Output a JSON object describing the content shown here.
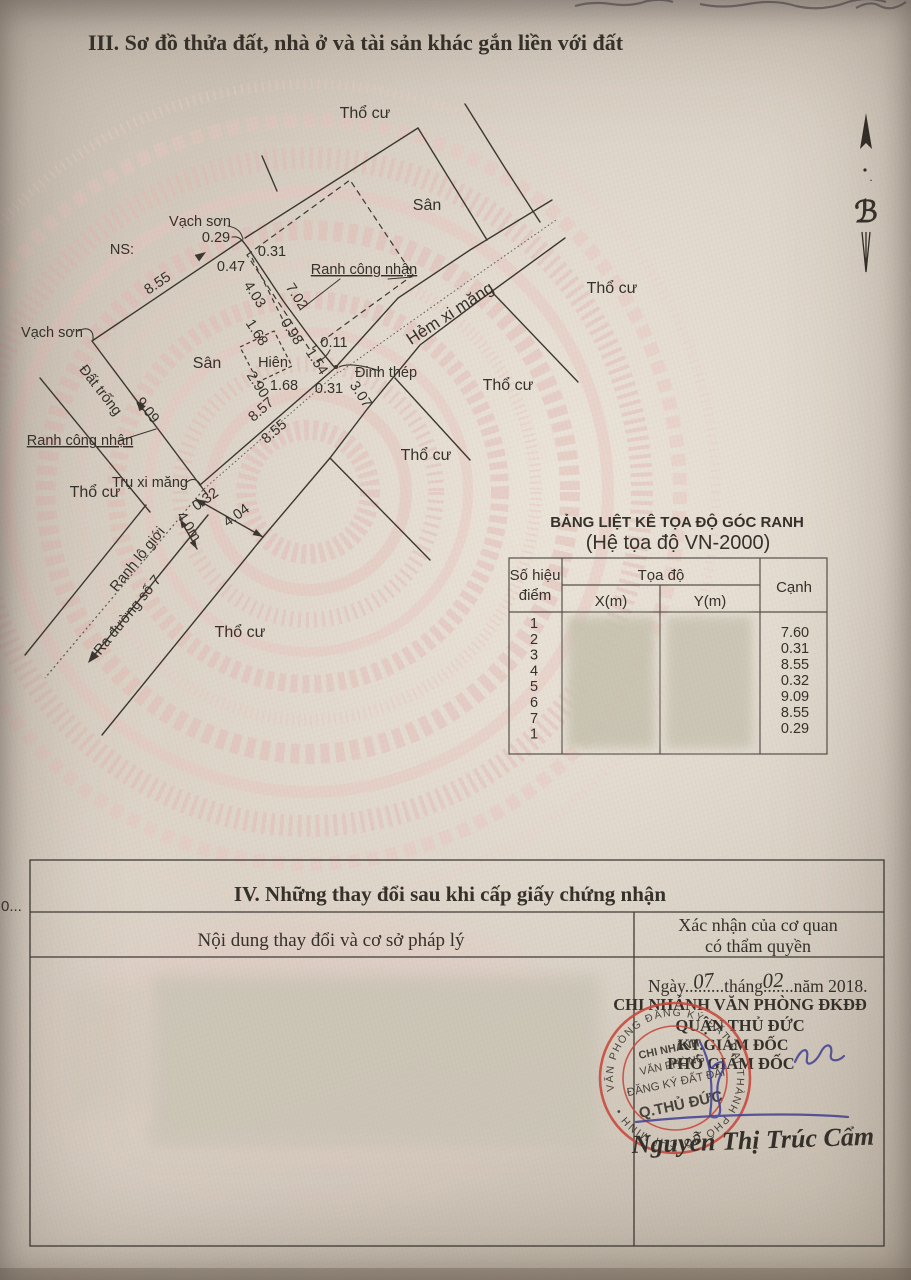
{
  "header": {
    "section_title": "III. Sơ đồ thửa đất, nhà ở và tài sản khác gắn liền với đất"
  },
  "compass": {
    "glyph": "ℬ",
    "dot": "."
  },
  "diagram": {
    "labels": [
      {
        "t": "Thổ cư",
        "x": 365,
        "y": 118,
        "s": 16
      },
      {
        "t": "Sân",
        "x": 427,
        "y": 210,
        "s": 16
      },
      {
        "t": "Vạch sơn",
        "x": 200,
        "y": 226
      },
      {
        "t": "0.29",
        "x": 216,
        "y": 242
      },
      {
        "t": "NS:",
        "x": 122,
        "y": 254
      },
      {
        "t": "0.31",
        "x": 272,
        "y": 256
      },
      {
        "t": "0.47",
        "x": 231,
        "y": 271
      },
      {
        "t": "8.55",
        "x": 160,
        "y": 287,
        "r": -34
      },
      {
        "t": "4.03",
        "x": 251,
        "y": 297,
        "r": 57
      },
      {
        "t": "7.02",
        "x": 293,
        "y": 299,
        "r": 57
      },
      {
        "t": "Ranh công nhận",
        "x": 364,
        "y": 274,
        "u": true
      },
      {
        "t": "1.68",
        "x": 253,
        "y": 335,
        "r": 57
      },
      {
        "t": "0.98",
        "x": 288,
        "y": 334,
        "r": 57
      },
      {
        "t": "0.11",
        "x": 334,
        "y": 347
      },
      {
        "t": "Sân",
        "x": 207,
        "y": 368,
        "s": 16
      },
      {
        "t": "Hiên",
        "x": 273,
        "y": 367
      },
      {
        "t": "1.54",
        "x": 313,
        "y": 364,
        "r": 57
      },
      {
        "t": "Đinh thép",
        "x": 386,
        "y": 377
      },
      {
        "t": "2.90",
        "x": 254,
        "y": 387,
        "r": 57
      },
      {
        "t": "1.68",
        "x": 284,
        "y": 390
      },
      {
        "t": "0.31",
        "x": 329,
        "y": 393
      },
      {
        "t": "3.07",
        "x": 357,
        "y": 397,
        "r": 57
      },
      {
        "t": "8.57",
        "x": 264,
        "y": 413,
        "r": -41
      },
      {
        "t": "8.55",
        "x": 277,
        "y": 435,
        "r": -41
      },
      {
        "t": "Hẻm xi măng",
        "x": 453,
        "y": 318,
        "r": -33,
        "s": 17
      },
      {
        "t": "Thổ cư",
        "x": 612,
        "y": 293,
        "s": 16
      },
      {
        "t": "Thổ cư",
        "x": 508,
        "y": 390,
        "s": 16
      },
      {
        "t": "Thổ cư",
        "x": 426,
        "y": 460,
        "s": 16
      },
      {
        "t": "Đất trống",
        "x": 97,
        "y": 393,
        "r": 52
      },
      {
        "t": "9.09",
        "x": 144,
        "y": 413,
        "r": 52
      },
      {
        "t": "Vạch sơn",
        "x": 52,
        "y": 337
      },
      {
        "t": "Ranh công nhận",
        "x": 80,
        "y": 445,
        "u": true
      },
      {
        "t": "Thổ cư",
        "x": 95,
        "y": 497,
        "s": 16
      },
      {
        "t": "Trụ xi măng",
        "x": 150,
        "y": 487
      },
      {
        "t": "0.32",
        "x": 208,
        "y": 503,
        "r": -36
      },
      {
        "t": "4.04",
        "x": 239,
        "y": 519,
        "r": -36
      },
      {
        "t": "4.0m",
        "x": 185,
        "y": 529,
        "r": 57
      },
      {
        "t": "Ranh lộ giới",
        "x": 141,
        "y": 562,
        "r": -51
      },
      {
        "t": "Ra đường số 7",
        "x": 131,
        "y": 618,
        "r": -51
      },
      {
        "t": "Thổ cư",
        "x": 240,
        "y": 637,
        "s": 16
      }
    ]
  },
  "coord_table": {
    "title1": "BẢNG LIỆT KÊ TỌA ĐỘ GÓC RANH",
    "title2": "(Hệ tọa độ VN-2000)",
    "col_point_line1": "Số hiệu",
    "col_point_line2": "điểm",
    "col_coord": "Tọa độ",
    "col_x": "X(m)",
    "col_y": "Y(m)",
    "col_edge": "Cạnh",
    "points": [
      "1",
      "2",
      "3",
      "4",
      "5",
      "6",
      "7",
      "1"
    ],
    "edges": [
      "7.60",
      "0.31",
      "8.55",
      "0.32",
      "9.09",
      "8.55",
      "0.29"
    ]
  },
  "section4": {
    "margin_note": "0...",
    "title": "IV. Những thay đổi sau khi cấp giấy chứng nhận",
    "col_left": "Nội dung thay đổi và cơ sở pháp lý",
    "col_right_line1": "Xác nhận của cơ quan",
    "col_right_line2": "có thẩm quyền",
    "approval": {
      "date_text": "Ngày.........tháng.......năm 2018.",
      "hand_day": "07",
      "hand_month": "02",
      "org_line1": "CHI NHÁNH VĂN PHÒNG ĐKĐĐ",
      "org_line2": "QUẬN THỦ ĐỨC",
      "role_line1": "KT.GIÁM ĐỐC",
      "role_line2": "PHÓ GIÁM ĐỐC",
      "signer_name": "Nguyễn Thị Trúc Cẩm"
    },
    "stamp": {
      "ring_text": "VĂN PHÒNG ĐĂNG KÝ ĐẤT ĐAI THÀNH PHỐ HỒ CHÍ MINH •",
      "center_lines": [
        "CHI NHÁNH",
        "VĂN PHÒNG",
        "ĐĂNG KÝ ĐẤT ĐAI",
        "Q.THỦ ĐỨC"
      ]
    }
  }
}
